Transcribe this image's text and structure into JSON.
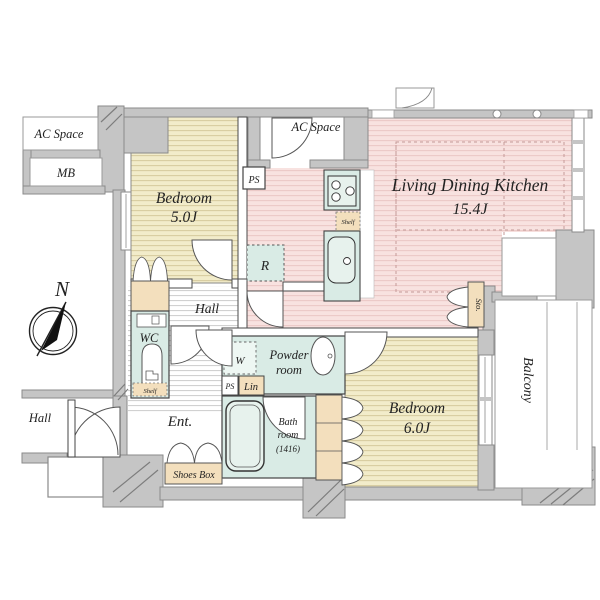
{
  "floor_plan": {
    "compass": {
      "north_label": "N"
    },
    "rooms": {
      "ac_space_left": {
        "label": "AC Space"
      },
      "meter_box": {
        "label": "MB"
      },
      "bedroom_5": {
        "label": "Bedroom",
        "area": "5.0J"
      },
      "ac_space_top": {
        "label": "AC Space"
      },
      "pipe_space_top": {
        "label": "PS"
      },
      "living_dining_kitchen": {
        "label": "Living Dining Kitchen",
        "area": "15.4J"
      },
      "hall": {
        "label": "Hall"
      },
      "wc": {
        "label": "WC"
      },
      "powder_room": {
        "label_line1": "Powder",
        "label_line2": "room"
      },
      "bath_room": {
        "label_line1": "Bath",
        "label_line2": "room",
        "label_line3": "(1416)"
      },
      "bedroom_6": {
        "label": "Bedroom",
        "area": "6.0J"
      },
      "storage": {
        "label": "Sto."
      },
      "balcony": {
        "label": "Balcony"
      },
      "common_hall": {
        "label": "Hall"
      },
      "entrance": {
        "label": "Ent."
      }
    },
    "fixtures": {
      "refrigerator": {
        "label": "R"
      },
      "kitchen_shelf": {
        "label": "Shelf"
      },
      "wc_shelf": {
        "label": "Shelf"
      },
      "washer": {
        "label": "W"
      },
      "pipe_space_lower": {
        "label": "PS"
      },
      "linen": {
        "label": "Lin"
      },
      "shoes_box": {
        "label": "Shoes Box"
      }
    },
    "colors": {
      "wall_gray": "#c5c5c5",
      "tatami_tan": "#f2ecca",
      "ldk_pink": "#f8e2e0",
      "wet_area_teal": "#d9ebe5",
      "closet_tan": "#f3dfbd"
    }
  }
}
